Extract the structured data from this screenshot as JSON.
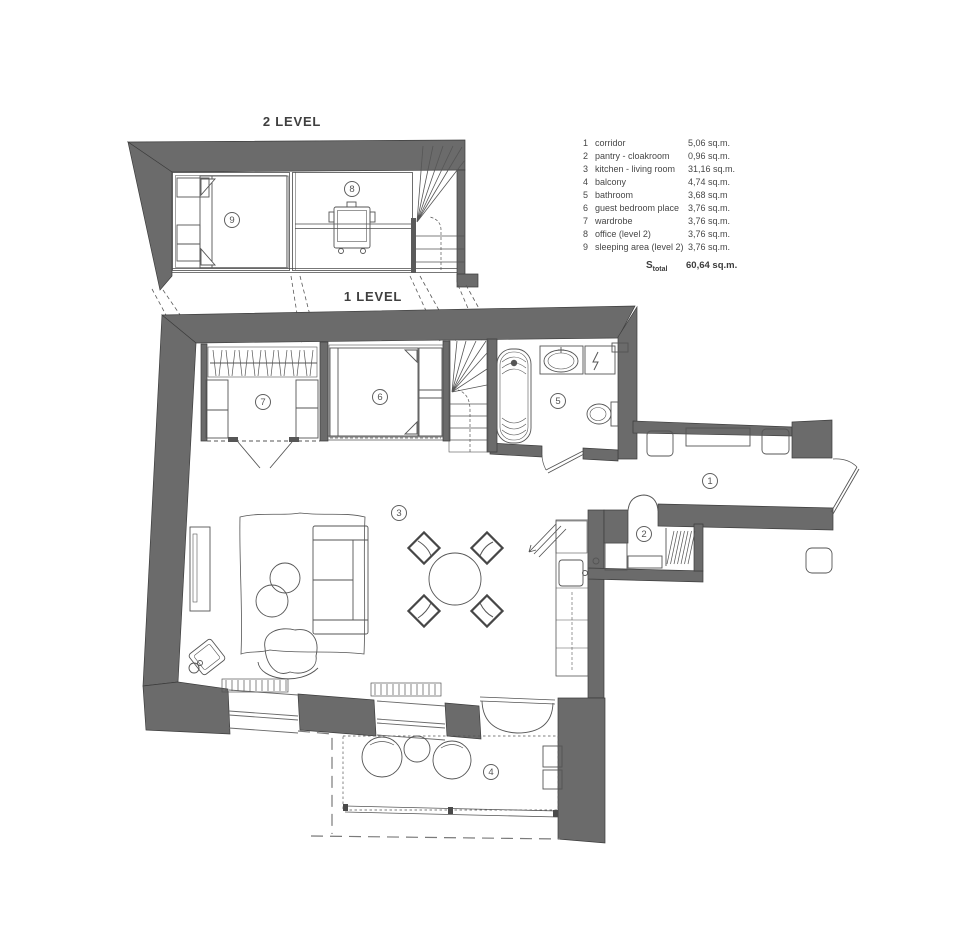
{
  "levels": {
    "level2_label": "2 LEVEL",
    "level1_label": "1 LEVEL"
  },
  "rooms": [
    {
      "number": "1",
      "name": "corridor",
      "area": "5,06 sq.m."
    },
    {
      "number": "2",
      "name": "pantry - cloakroom",
      "area": "0,96 sq.m."
    },
    {
      "number": "3",
      "name": "kitchen - living room",
      "area": "31,16 sq.m."
    },
    {
      "number": "4",
      "name": "balcony",
      "area": "4,74 sq.m."
    },
    {
      "number": "5",
      "name": "bathroom",
      "area": "3,68 sq.m"
    },
    {
      "number": "6",
      "name": "guest bedroom place",
      "area": "3,76 sq.m."
    },
    {
      "number": "7",
      "name": "wardrobe",
      "area": "3,76 sq.m."
    },
    {
      "number": "8",
      "name": "office (level 2)",
      "area": "3,76 sq.m."
    },
    {
      "number": "9",
      "name": "sleeping area (level 2)",
      "area": "3,76 sq.m."
    }
  ],
  "total": {
    "label_main": "S",
    "label_sub": "total",
    "value": "60,64 sq.m."
  },
  "colors": {
    "wall": "#6b6b6b",
    "wall_edge": "#3d3d3d",
    "line": "#555555",
    "text": "#474747"
  }
}
